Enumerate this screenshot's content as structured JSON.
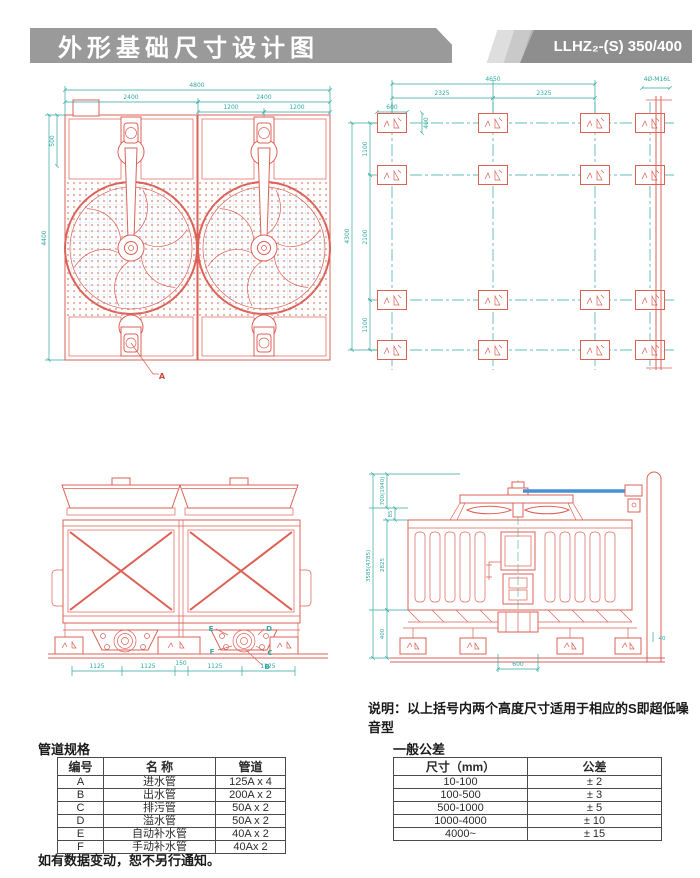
{
  "header": {
    "title": "外形基础尺寸设计图",
    "model": "LLHZ₂-(S) 350/400"
  },
  "plan": {
    "overall_w": "4800",
    "halves": [
      "2400",
      "2400"
    ],
    "quarters": [
      "1200",
      "1200"
    ],
    "overall_h": "4400",
    "offset": "500",
    "detail_label": "A"
  },
  "foundation": {
    "overall_w": "4650",
    "bays": [
      "2325",
      "2325"
    ],
    "pad_w": "600",
    "pad_h": "400",
    "overall_h": "4300",
    "vgaps": [
      "1100",
      "2100",
      "1100"
    ],
    "anchor_note": "4Ø-M16L"
  },
  "front": {
    "segments": [
      "1125",
      "1125",
      "150",
      "1125",
      "1125"
    ],
    "labels": {
      "b": "B",
      "c": "C",
      "d": "D",
      "e": "E",
      "f": "F"
    }
  },
  "side": {
    "overall_h": "3585(4785)",
    "fan_h": "700(1940)",
    "lip": "85",
    "body_h": "2825",
    "base_h": "400",
    "pipe_w": "600",
    "pad_off": "40"
  },
  "note": "说明：以上括号内两个高度尺寸适用于相应的S即超低噪音型",
  "pipe_table": {
    "title": "管道规格",
    "headers": [
      "编号",
      "名 称",
      "管道"
    ],
    "rows": [
      [
        "A",
        "进水管",
        "125A x 4"
      ],
      [
        "B",
        "出水管",
        "200A x 2"
      ],
      [
        "C",
        "排污管",
        "50A x 2"
      ],
      [
        "D",
        "溢水管",
        "50A x 2"
      ],
      [
        "E",
        "自动补水管",
        "40A x 2"
      ],
      [
        "F",
        "手动补水管",
        "40Ax 2"
      ]
    ]
  },
  "tolerance_table": {
    "title": "一般公差",
    "headers": [
      "尺寸（mm）",
      "公差"
    ],
    "rows": [
      [
        "10-100",
        "± 2"
      ],
      [
        "100-500",
        "± 3"
      ],
      [
        "500-1000",
        "± 5"
      ],
      [
        "1000-4000",
        "± 10"
      ],
      [
        "4000~",
        "± 15"
      ]
    ]
  },
  "footer_note": "如有数据变动，恕不另行通知。",
  "colors": {
    "line_red": "#dd6055",
    "dim_teal": "#2fa8a0",
    "fill_yellow": "#fdf8d0",
    "grid_blue": "#bcd8ec",
    "accent_blue": "#4a90d9",
    "header_gray": "#9a9a9a"
  }
}
